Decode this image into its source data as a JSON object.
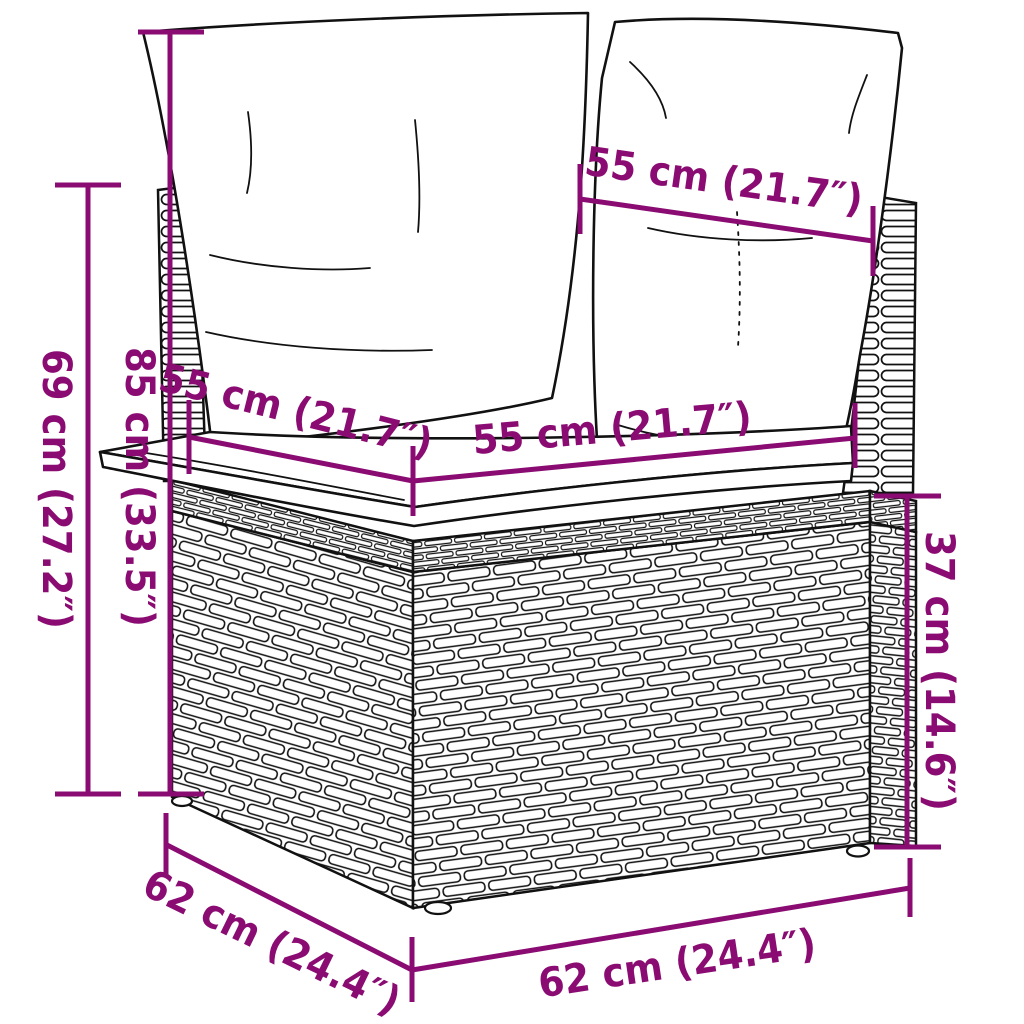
{
  "colors": {
    "dimension_accent": "#8A0C72",
    "line_art": "#111111",
    "background": "#FFFFFF"
  },
  "dimensions": {
    "height_with_cushion": "85 cm (33.5″)",
    "frame_height": "69 cm (27.2″)",
    "base_height": "37 cm (14.6″)",
    "backrest_width_top": "55 cm (21.7″)",
    "seat_width": "55 cm (21.7″)",
    "seat_depth": "55 cm (21.7″)",
    "base_depth": "62 cm (24.4″)",
    "base_width": "62 cm (24.4″)"
  }
}
